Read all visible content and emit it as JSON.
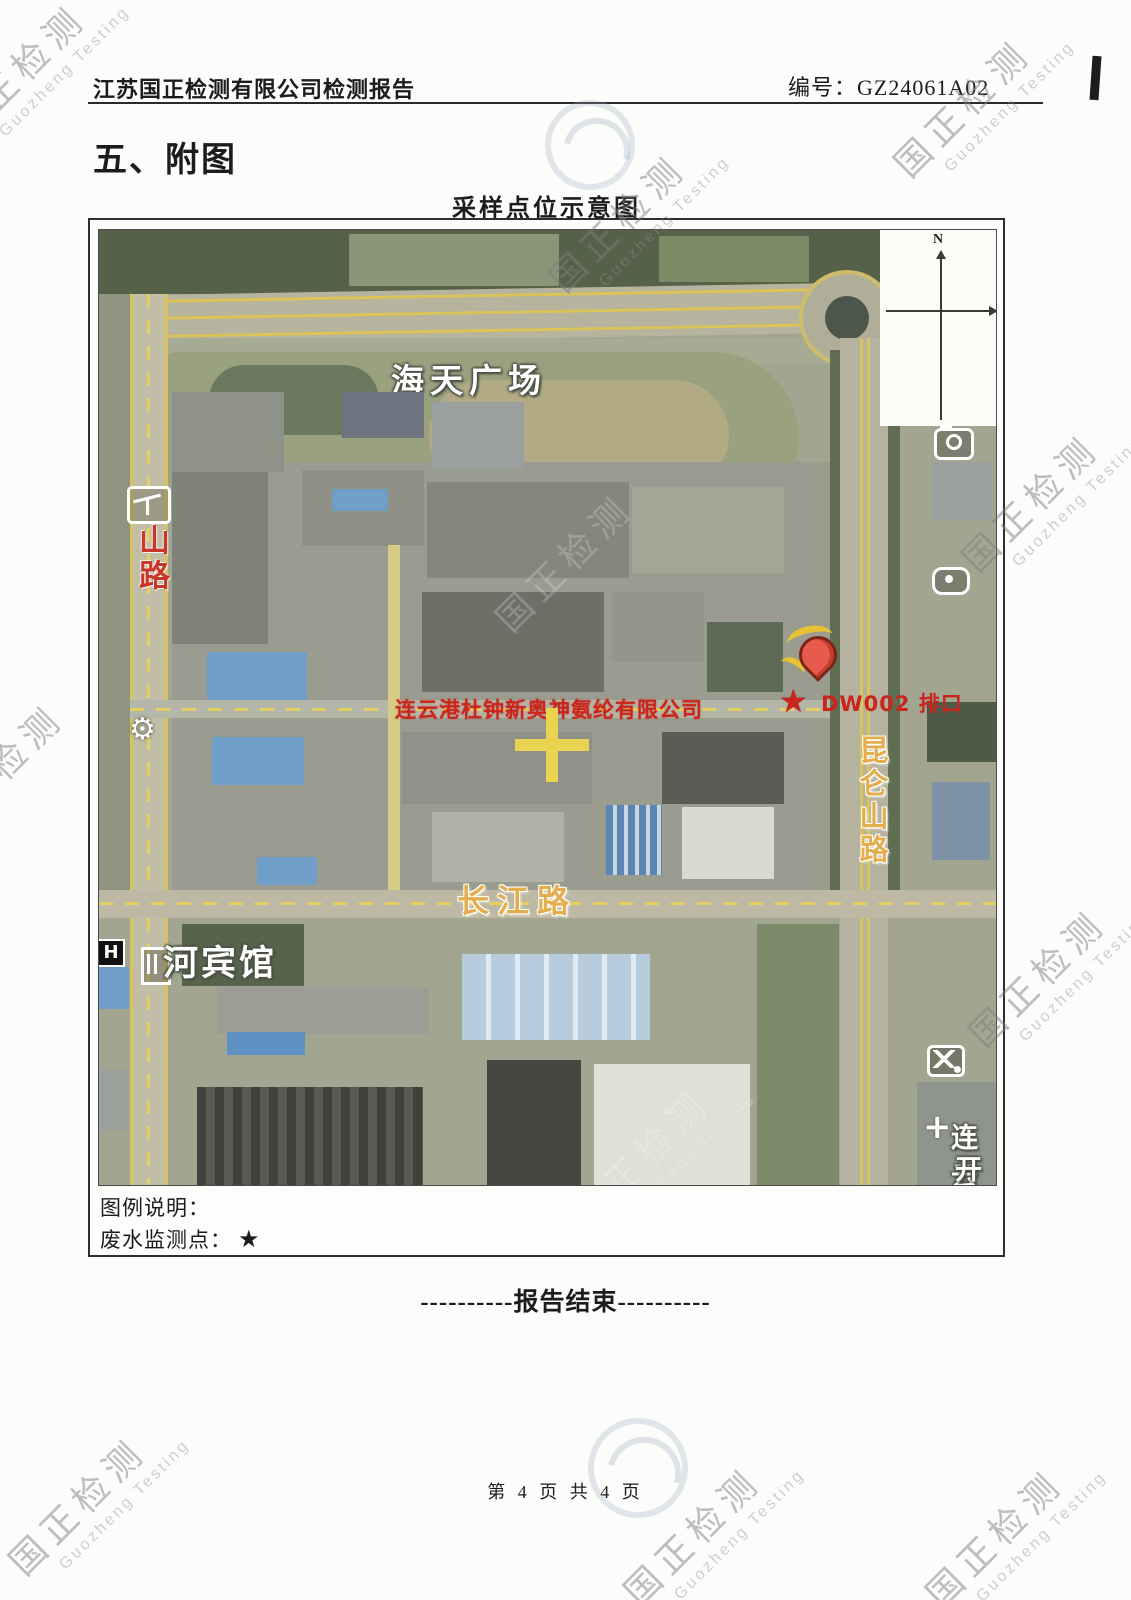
{
  "page": {
    "header_title": "江苏国正检测有限公司检测报告",
    "report_no": "编号：GZ24061A02",
    "section_title": "五、附图",
    "end_line": "----------报告结束----------",
    "page_footer": "第 4 页 共 4 页"
  },
  "map": {
    "title": "采样点位示意图",
    "compass_n": "N",
    "labels": {
      "plaza": "海天广场",
      "left_road": "山路",
      "right_road": "昆仑山路",
      "bottom_road": "长江路",
      "hotel": "河宾馆",
      "hotel_icon_letter": "H",
      "company": "连云港杜钟新奥神氨纶有限公司",
      "outfall_station": "DW002 排口",
      "outfall_star": "★",
      "corner_text_line1": "连云",
      "corner_text_line2": "开发"
    },
    "legend": {
      "heading": "图例说明：",
      "item": "废水监测点：",
      "symbol": "★"
    }
  },
  "watermark": {
    "cn": "国正检测",
    "en": "Guozheng Testing"
  },
  "colors": {
    "accent_red": "#c9251c",
    "road_yellow": "#e4cf62",
    "label_yellow": "#e2ae4e"
  }
}
